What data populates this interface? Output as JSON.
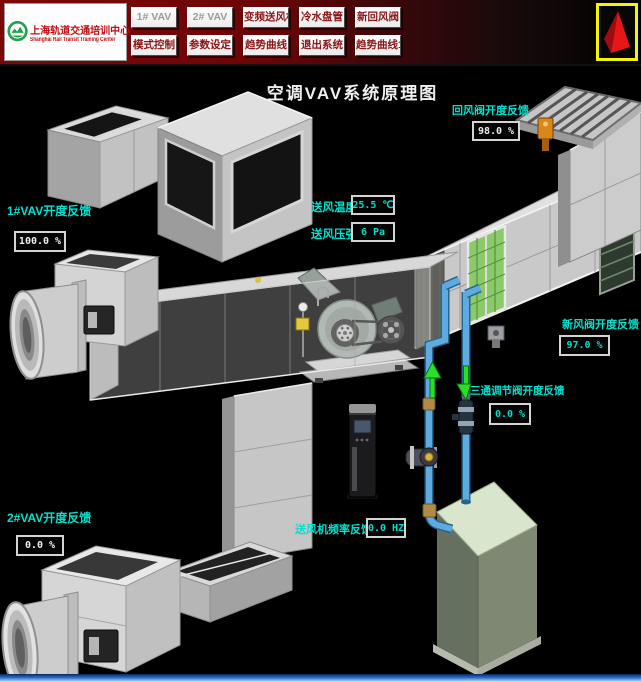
{
  "header": {
    "logo": {
      "title_cn": "上海轨道交通培训中心",
      "title_en": "Shanghai Rail Transit Training Center"
    },
    "buttons_row1": [
      "1# VAV",
      "2# VAV",
      "变频送风机",
      "冷水盘管",
      "新回风阀"
    ],
    "buttons_row2": [
      "模式控制",
      "参数设定",
      "趋势曲线",
      "退出系统",
      "趋势曲线1#"
    ]
  },
  "diagram": {
    "title": "空调VAV系统原理图"
  },
  "readouts": {
    "vav1": {
      "label": "1#VAV开度反馈",
      "value": "100.0 %"
    },
    "vav2": {
      "label": "2#VAV开度反馈",
      "value": "0.0 %"
    },
    "return_damper": {
      "label": "回风阀开度反馈",
      "value": "98.0 %"
    },
    "supply_temp": {
      "label": "送风温度",
      "value": "25.5 ℃"
    },
    "supply_pressure": {
      "label": "送风压强",
      "value": "6 Pa"
    },
    "fresh_damper": {
      "label": "新风阀开度反馈",
      "value": "97.0 %"
    },
    "three_way_valve": {
      "label": "三通调节阀开度反馈",
      "value": "0.0 %"
    },
    "fan_frequency": {
      "label": "送风机频率反馈",
      "value": "0.0 HZ"
    }
  },
  "colors": {
    "background": "#000000",
    "header_red": "#6c0507",
    "label_cyan": "#00e2cf",
    "value_silver": "#e9efe9",
    "value_cyan": "#00dcc6",
    "pipe_blue": "#5fabdf",
    "coil_green": "#8cc96b",
    "flow_arrow_green": "#28e028",
    "actuator_orange": "#d8871c",
    "logo_green": "#22a24c",
    "brand_border_yellow": "#f5f500",
    "brand_pyramid_red": "#e51717",
    "taskbar_blue": "#2e6cc8"
  }
}
